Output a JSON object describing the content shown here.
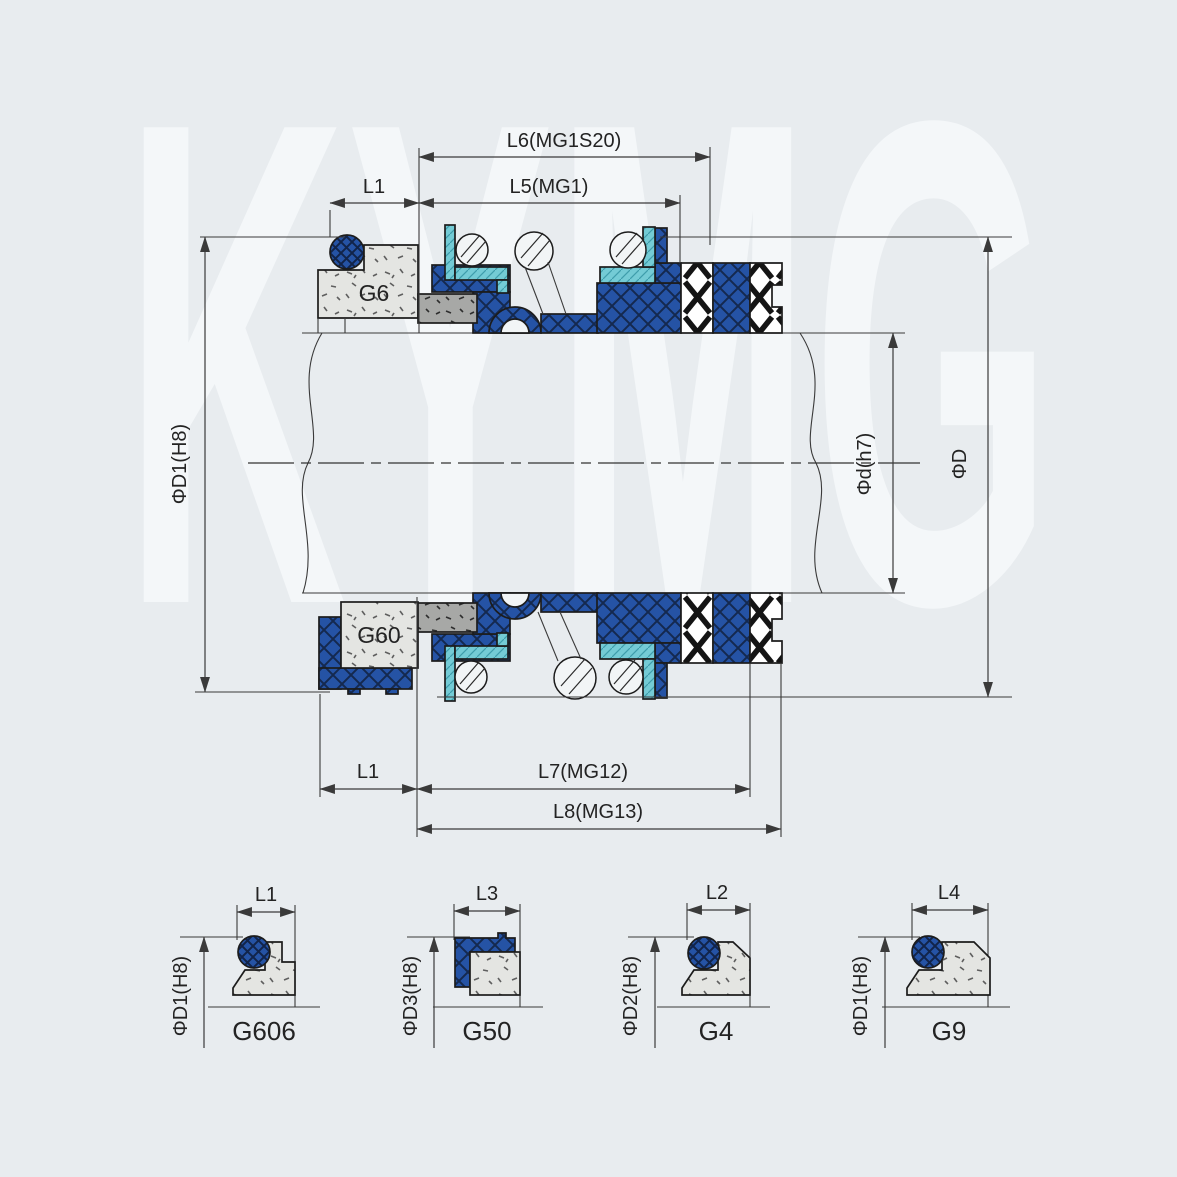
{
  "watermark_text": "KYMG",
  "colors": {
    "background": "#e8ecef",
    "part_blue": "#2553a5",
    "part_blue_hatch": "#14294f",
    "part_cyan": "#74cbd5",
    "seat_light_grey": "#e4e5e2",
    "block_mid_grey": "#a7a8a6",
    "line": "#2a2a2a",
    "band_white": "#ffffff"
  },
  "main_view": {
    "top_dimensions": {
      "l6": "L6(MG1S20)",
      "l5": "L5(MG1)",
      "l1": "L1"
    },
    "left_dimension": "ΦD1(H8)",
    "right_dimensions": {
      "shaft": "Φd(h7)",
      "outer": "ΦD"
    },
    "bottom_dimensions": {
      "l1": "L1",
      "l7": "L7(MG12)",
      "l8": "L8(MG13)"
    },
    "part_labels": {
      "upper_seat": "G6",
      "lower_seat": "G60"
    }
  },
  "detail_views": [
    {
      "name": "G606",
      "length": "L1",
      "diameter": "ΦD1(H8)"
    },
    {
      "name": "G50",
      "length": "L3",
      "diameter": "ΦD3(H8)"
    },
    {
      "name": "G4",
      "length": "L2",
      "diameter": "ΦD2(H8)"
    },
    {
      "name": "G9",
      "length": "L4",
      "diameter": "ΦD1(H8)"
    }
  ]
}
